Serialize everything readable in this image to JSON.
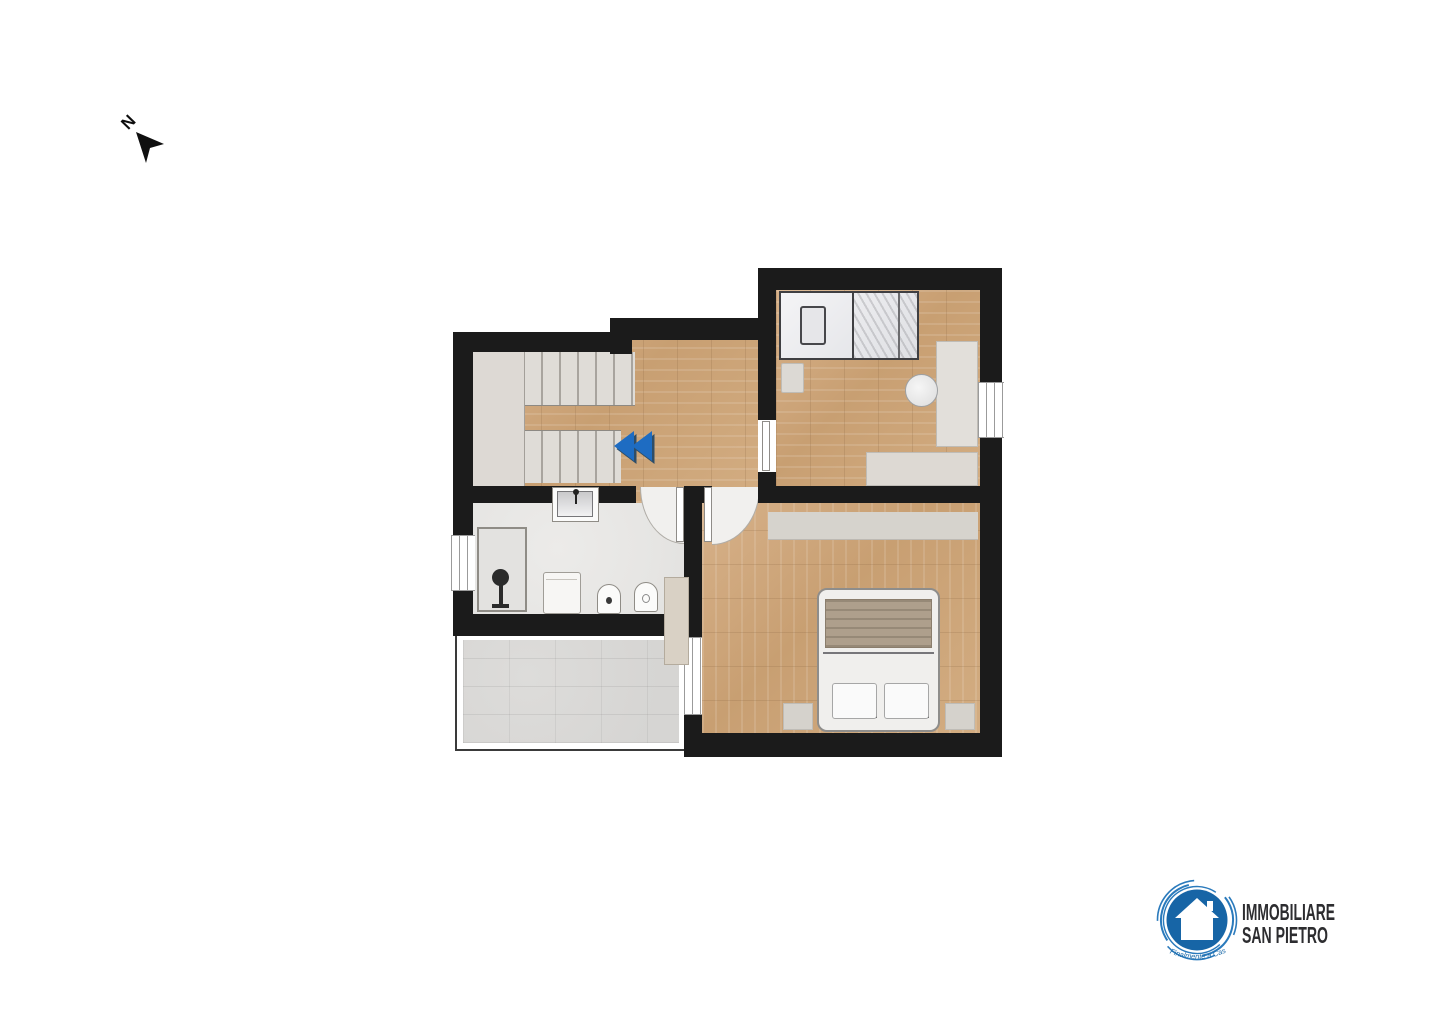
{
  "north_indicator": {
    "label": "N"
  },
  "plan": {
    "wall_color": "#1b1b1b",
    "wood_floor_color": "#cfa87c",
    "bathroom_floor_color": "#e6e5e3",
    "terrace_tile_color": "#d9d8d6",
    "stair_tread_color": "#dfdcd7",
    "furniture_color": "#dcd9d4",
    "stairs_arrow_color": "#1e6cc2",
    "rooms": [
      {
        "name": "stairwell"
      },
      {
        "name": "hallway"
      },
      {
        "name": "small-bedroom"
      },
      {
        "name": "bathroom"
      },
      {
        "name": "master-bedroom"
      },
      {
        "name": "terrace"
      }
    ],
    "furniture": [
      "staircase",
      "single-bed",
      "nightstand",
      "desk",
      "desk-chair",
      "shelf",
      "wardrobe",
      "double-bed",
      "sink",
      "shower",
      "washing-machine",
      "bidet",
      "toilet",
      "storage-cabinet"
    ]
  },
  "logo": {
    "line1": "IMMOBILIARE",
    "line2": "SAN PIETRO",
    "tagline": "Finalmente a Casa",
    "brand_color": "#1765a6",
    "text_color": "#2d2d30"
  }
}
